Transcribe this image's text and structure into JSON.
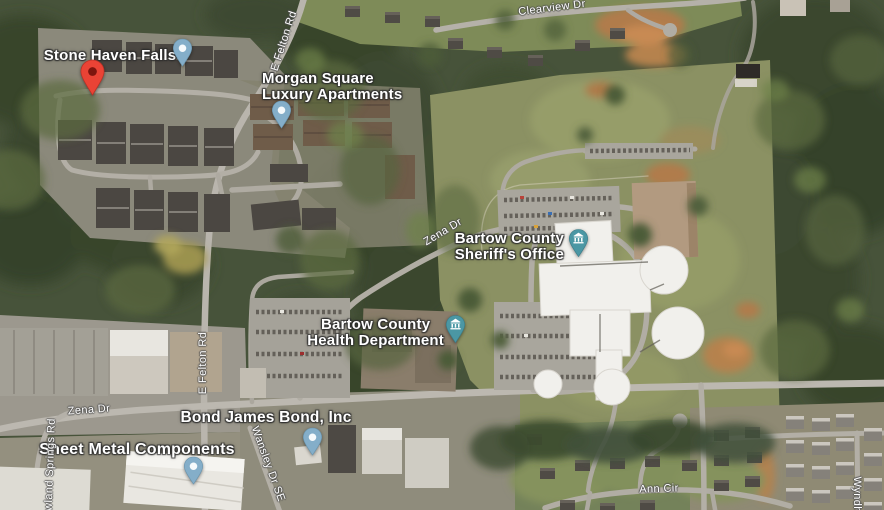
{
  "map": {
    "view": "satellite",
    "place_labels": [
      {
        "id": "stone-haven-falls",
        "lines": [
          "Stone Haven Falls"
        ]
      },
      {
        "id": "morgan-square",
        "lines": [
          "Morgan Square",
          "Luxury Apartments"
        ]
      },
      {
        "id": "sheriffs-office",
        "lines": [
          "Bartow County",
          "Sheriff's Office"
        ]
      },
      {
        "id": "health-department",
        "lines": [
          "Bartow County",
          "Health Department"
        ]
      },
      {
        "id": "bond-james-bond",
        "lines": [
          "Bond James Bond, Inc"
        ]
      },
      {
        "id": "sheet-metal-components",
        "lines": [
          "Sheet Metal Components"
        ]
      }
    ],
    "road_labels": [
      {
        "id": "clearview-dr",
        "text": "Clearview Dr"
      },
      {
        "id": "e-felton-rd-north",
        "text": "E Felton Rd"
      },
      {
        "id": "e-felton-rd-south",
        "text": "E Felton Rd"
      },
      {
        "id": "zena-dr-east",
        "text": "Zena Dr"
      },
      {
        "id": "zena-dr-west",
        "text": "Zena Dr"
      },
      {
        "id": "ann-cir",
        "text": "Ann Cir"
      },
      {
        "id": "rowland-springs-rd",
        "text": "Rowland Springs Rd"
      },
      {
        "id": "wansley-dr-se",
        "text": "Wansley Dr SE"
      },
      {
        "id": "wyndham-partial",
        "text": "Wyndha"
      }
    ],
    "markers": [
      {
        "id": "saved-red-pin",
        "type": "red-place-pin"
      },
      {
        "id": "stone-haven-pin",
        "type": "blue-place-pin"
      },
      {
        "id": "morgan-square-pin",
        "type": "blue-place-pin"
      },
      {
        "id": "bond-james-bond-pin",
        "type": "blue-place-pin"
      },
      {
        "id": "sheet-metal-pin",
        "type": "blue-place-pin"
      },
      {
        "id": "sheriffs-office-marker",
        "type": "civic-building-marker"
      },
      {
        "id": "health-department-marker",
        "type": "civic-building-marker"
      }
    ],
    "colors": {
      "pin_blue": "#84aec9",
      "pin_blue_stroke": "#6a94ad",
      "pin_dot": "#f6fafc",
      "pin_red": "#EA4335",
      "pin_red_stroke": "#b63227",
      "pin_red_inner": "#7E150E",
      "marker_teal": "#4B97A4",
      "marker_teal_stroke": "#3a7d89",
      "glyph_white": "#ffffff"
    }
  }
}
